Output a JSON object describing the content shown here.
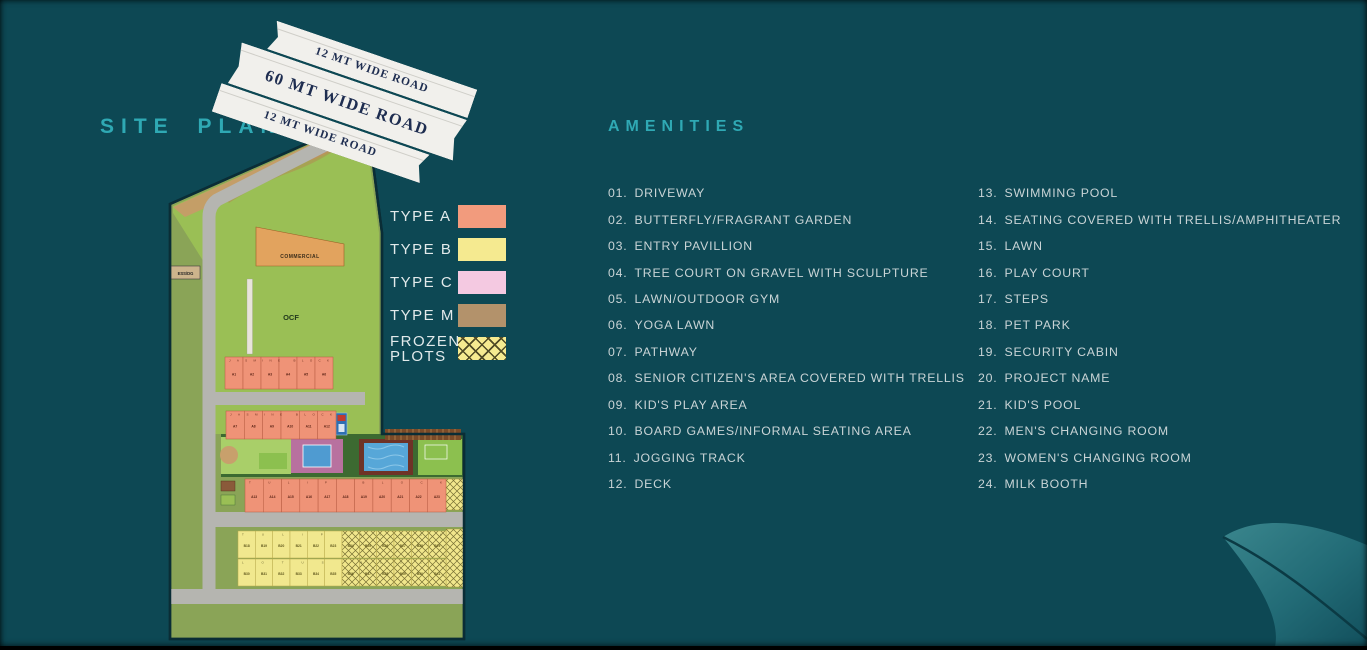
{
  "title": "SITE PLAN",
  "roads": {
    "top": "12 MT WIDE ROAD",
    "middle": "60 MT WIDE ROAD",
    "bottom": "12 MT WIDE ROAD"
  },
  "legend": {
    "items": [
      {
        "label": "TYPE A",
        "color": "#f29b7d",
        "pattern": "solid"
      },
      {
        "label": "TYPE B",
        "color": "#f5ea90",
        "pattern": "solid"
      },
      {
        "label": "TYPE C",
        "color": "#f4c9e1",
        "pattern": "solid"
      },
      {
        "label": "TYPE M",
        "color": "#b3926b",
        "pattern": "solid"
      },
      {
        "label": "FROZEN",
        "label2": "PLOTS",
        "color": "#f5ea90",
        "pattern": "crosshatch"
      }
    ]
  },
  "amenities": {
    "heading": "AMENITIES",
    "column1": [
      {
        "no": "01.",
        "label": "DRIVEWAY"
      },
      {
        "no": "02.",
        "label": "BUTTERFLY/FRAGRANT GARDEN"
      },
      {
        "no": "03.",
        "label": "ENTRY PAVILLION"
      },
      {
        "no": "04.",
        "label": "TREE COURT ON GRAVEL WITH SCULPTURE"
      },
      {
        "no": "05.",
        "label": "LAWN/OUTDOOR GYM"
      },
      {
        "no": "06.",
        "label": "YOGA LAWN"
      },
      {
        "no": "07.",
        "label": "PATHWAY"
      },
      {
        "no": "08.",
        "label": "SENIOR CITIZEN'S AREA COVERED WITH TRELLIS"
      },
      {
        "no": "09.",
        "label": "KID'S PLAY AREA"
      },
      {
        "no": "10.",
        "label": "BOARD GAMES/INFORMAL SEATING AREA"
      },
      {
        "no": "11.",
        "label": "JOGGING TRACK"
      },
      {
        "no": "12.",
        "label": "DECK"
      }
    ],
    "column2": [
      {
        "no": "13.",
        "label": "SWIMMING POOL"
      },
      {
        "no": "14.",
        "label": "SEATING COVERED WITH TRELLIS/AMPHITHEATER"
      },
      {
        "no": "15.",
        "label": "LAWN"
      },
      {
        "no": "16.",
        "label": "PLAY COURT"
      },
      {
        "no": "17.",
        "label": "STEPS"
      },
      {
        "no": "18.",
        "label": "PET PARK"
      },
      {
        "no": "19.",
        "label": "SECURITY CABIN"
      },
      {
        "no": "20.",
        "label": "PROJECT NAME"
      },
      {
        "no": "21.",
        "label": "KID'S POOL"
      },
      {
        "no": "22.",
        "label": "MEN'S CHANGING ROOM"
      },
      {
        "no": "23.",
        "label": "WOMEN'S CHANGING ROOM"
      },
      {
        "no": "24.",
        "label": "MILK BOOTH"
      }
    ]
  },
  "map": {
    "ess": "ESS/DG",
    "commercial": "COMMERCIAL",
    "ocf": "OCF",
    "blocks": {
      "c_column": {
        "name": "",
        "plots": [
          "C1",
          "C2",
          "C3",
          "C4",
          "C5"
        ]
      },
      "jasmine1": {
        "name": "JASMINE BLOCK",
        "plots": [
          "A1",
          "A2",
          "A3",
          "A4",
          "A5",
          "A6"
        ]
      },
      "jasmine2": {
        "name": "JASMINE BLOCK",
        "plots": [
          "A7",
          "A8",
          "A9",
          "A10",
          "A11",
          "A12"
        ]
      },
      "tulip_a": {
        "name": "TULIP BLOCK",
        "plots": [
          "A13",
          "A14",
          "A15",
          "A16",
          "A17",
          "A18",
          "A19",
          "A20",
          "A21",
          "A22",
          "A23"
        ]
      },
      "tulip_b": {
        "name": "TULIP BLOCK",
        "plots": [
          "B18",
          "B19",
          "B20",
          "B21",
          "B22",
          "B23",
          "B24",
          "B25",
          "B26",
          "B27",
          "B28",
          "B29"
        ]
      },
      "lotus_b": {
        "name": "LOTUS BLOCK",
        "plots": [
          "B30",
          "B31",
          "B32",
          "B33",
          "B34",
          "B35",
          "B36",
          "B37",
          "B38",
          "B39",
          "B40",
          "B41"
        ]
      },
      "left_column": {
        "name": "",
        "plots": [
          "B1",
          "B2",
          "B3",
          "B4",
          "B5",
          "B6",
          "B7",
          "B8",
          "B9",
          "B10",
          "B11",
          "B12",
          "B13",
          "B14",
          "B15",
          "B16",
          "B17"
        ]
      },
      "bottom_row": {
        "name": "LOTUS BLOCK",
        "plots": [
          "B42",
          "B43",
          "B44",
          "B45",
          "B46",
          "B47",
          "B48",
          "B49",
          "B50",
          "B51",
          "B52",
          "B53",
          "B54",
          "B55"
        ]
      },
      "m_plots": {
        "name": "",
        "plots": [
          "M1",
          "M2"
        ]
      }
    },
    "markers": [
      "01",
      "02",
      "03",
      "04",
      "05",
      "06",
      "07",
      "08",
      "09",
      "10",
      "11",
      "12",
      "13",
      "14",
      "15",
      "16",
      "17",
      "18",
      "19",
      "20",
      "21",
      "22",
      "23",
      "24"
    ]
  },
  "colors": {
    "background": "#0d4854",
    "accent_teal": "#2fa9b4",
    "type_a": "#f29b7d",
    "type_b": "#f5ea90",
    "type_c": "#f4c9e1",
    "type_m": "#b3926b",
    "road_gray": "#b5b5b0",
    "ocf_green": "#9abf55",
    "commercial_orange": "#e2a35e",
    "pool_blue": "#57a7d8"
  }
}
